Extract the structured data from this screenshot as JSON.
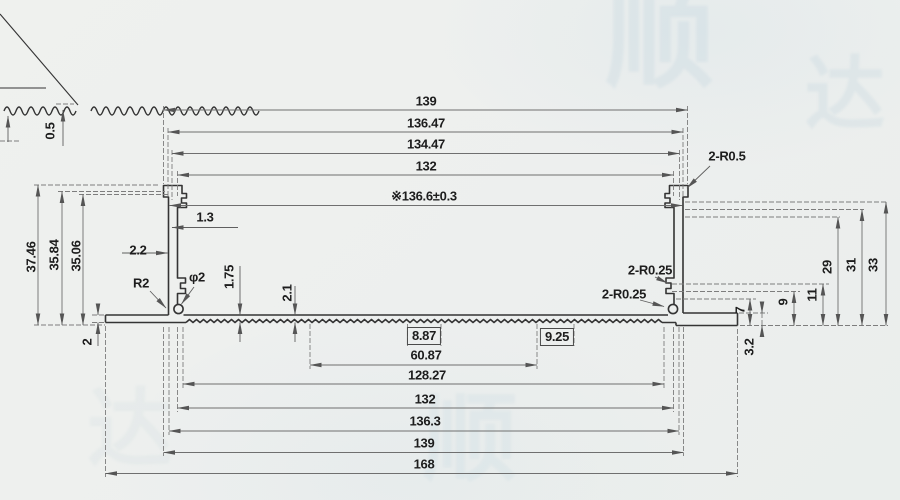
{
  "sheet": {
    "type": "extrusion-profile-section-drawing",
    "line_color": "#353535",
    "dim_color": "#787878",
    "paper_color": "#eef0ee"
  },
  "detail_view": {
    "tooth_height": "0.5"
  },
  "dims": {
    "top": [
      "139",
      "136.47",
      "134.47",
      "132"
    ],
    "ref_width": "※136.6±0.3",
    "top_right_radius": "2-R0.5",
    "left_heights": [
      "37.46",
      "35.84",
      "35.06"
    ],
    "lip": "1.3",
    "wall_thickness": "2.2",
    "fillet": "R2",
    "hole": "φ2",
    "ledge": "1.75",
    "base_thickness": "2.1",
    "left_flange_thickness": "2",
    "right_radii": [
      "2-R0.25",
      "2-R0.25"
    ],
    "right_outer_heights": [
      "29",
      "31",
      "33"
    ],
    "right_inner_heights": [
      "7",
      "9",
      "11"
    ],
    "right_flange_thickness": "3.2",
    "boxed": [
      "8.87",
      "9.25"
    ],
    "bottom": [
      "60.87",
      "128.27",
      "132",
      "136.3",
      "139",
      "168"
    ]
  },
  "watermark": {
    "glyphs": [
      "顺",
      "达"
    ]
  }
}
